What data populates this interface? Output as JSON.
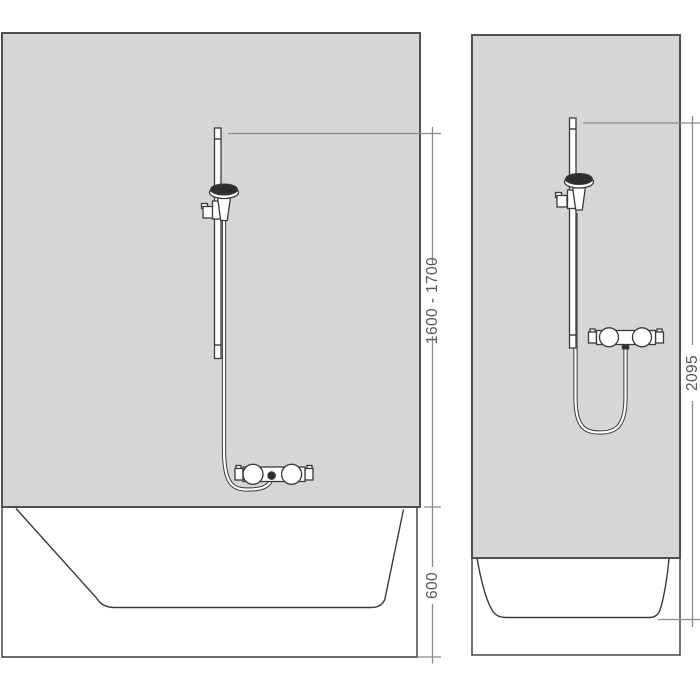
{
  "colors": {
    "background": "#ffffff",
    "wall_fill": "#d6d6d8",
    "wall_stroke": "#505053",
    "fixture_stroke": "#3a3a3c",
    "fixture_dark": "#2e2e30",
    "dimension_line": "#8b8b8e",
    "dimension_text": "#57585a"
  },
  "left_panel": {
    "scene": "shower set with thermostat mounted above bathtub",
    "dimensions": {
      "slide_bar_height": "1600 - 1700",
      "bathtub_rim_height": "600"
    }
  },
  "right_panel": {
    "scene": "shower set with thermostat mounted above shower tray",
    "dimensions": {
      "total_height": "2095"
    }
  }
}
